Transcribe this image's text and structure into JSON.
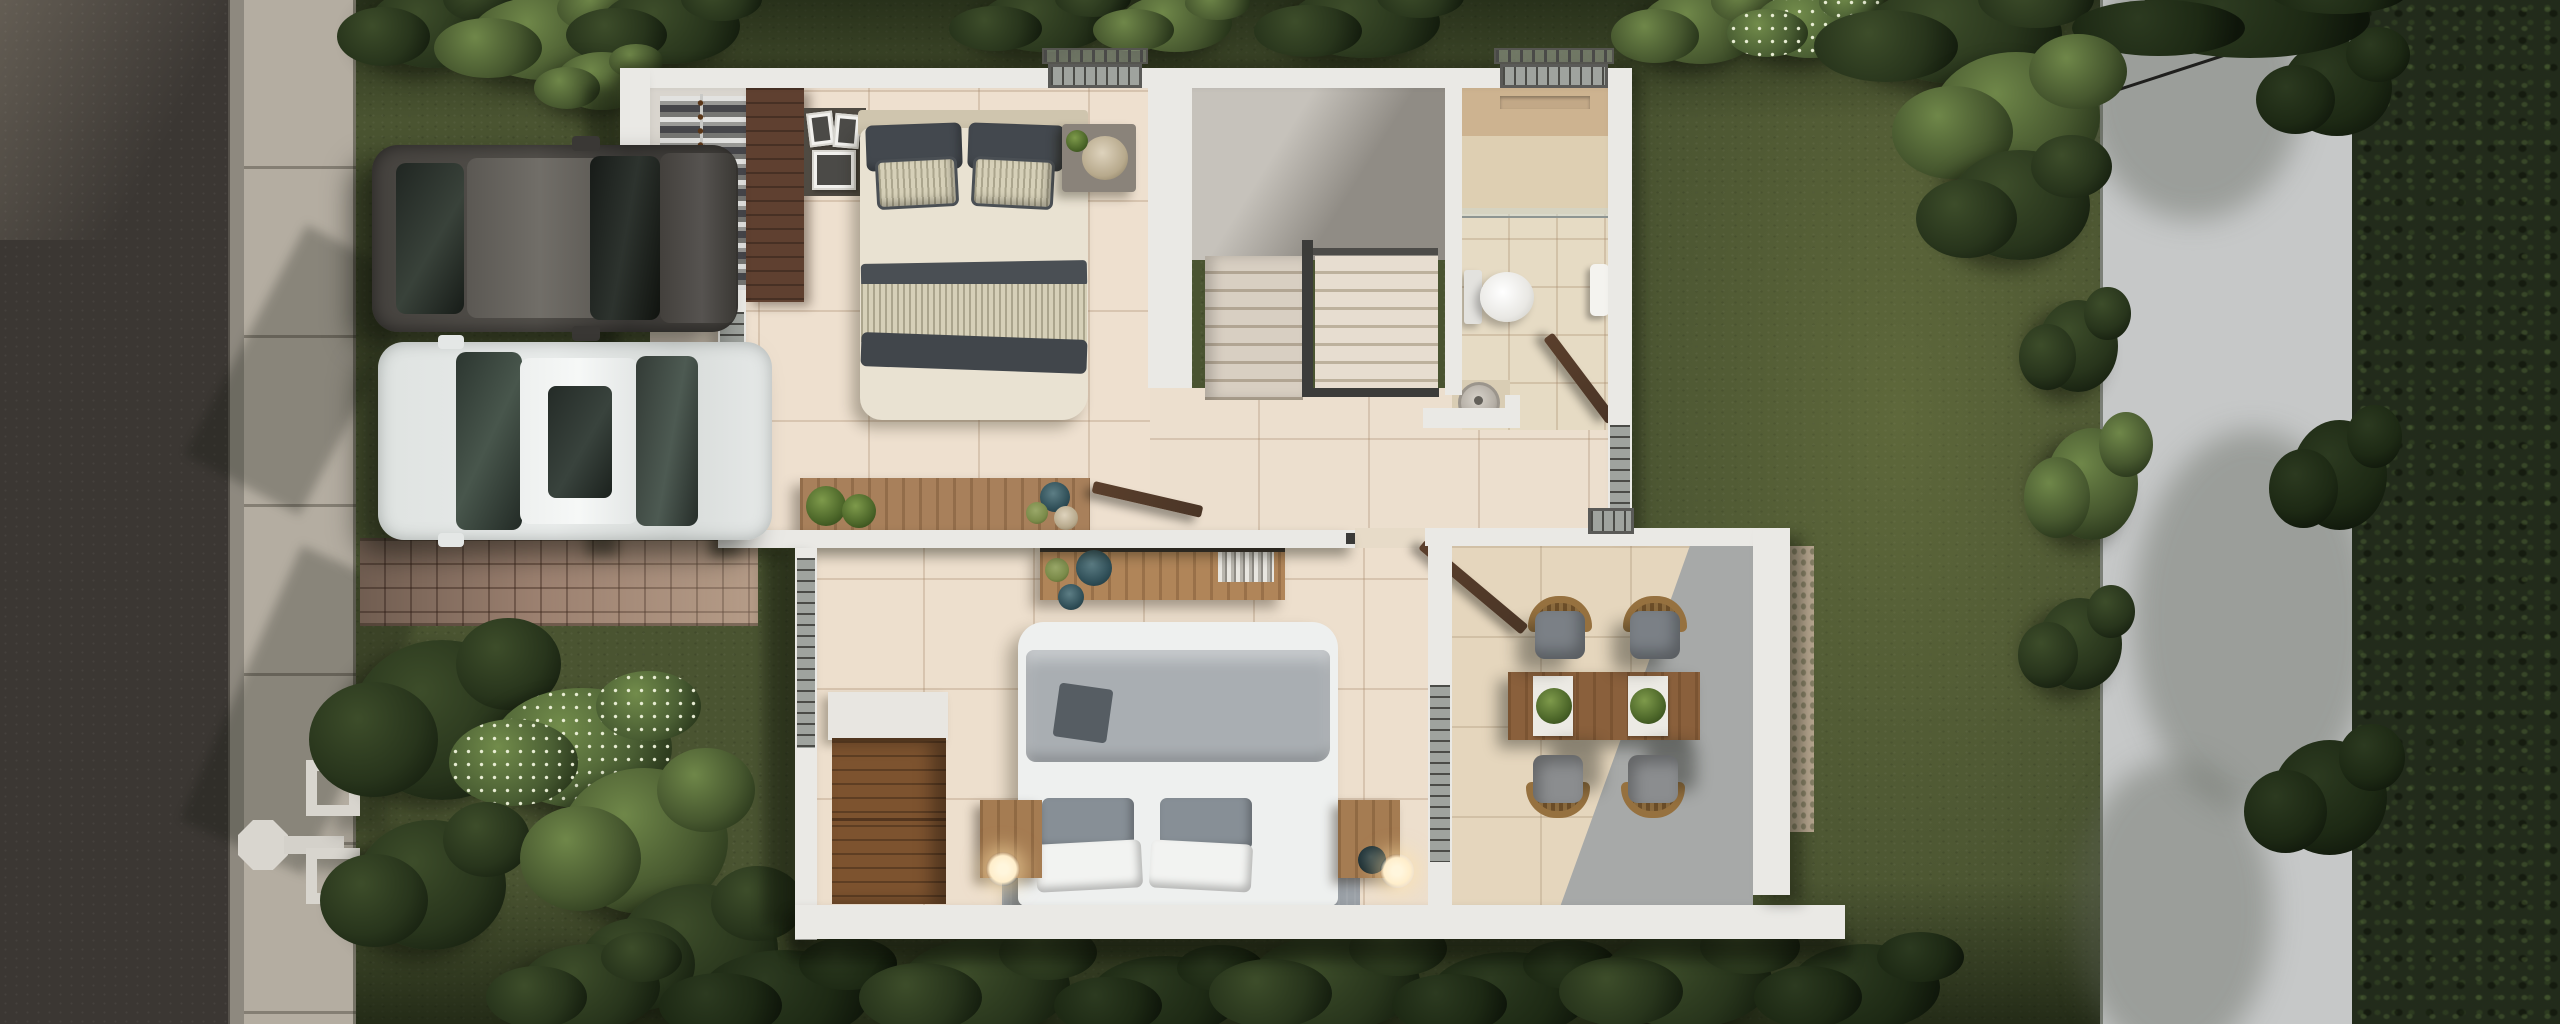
{
  "meta": {
    "title": "Top-down 3D architectural render — two-storey house floor plan with garden, driveway and terrace",
    "view": "top-down axonometric photorealistic render",
    "visible_text": "none"
  },
  "palette": {
    "grass": "#4a5431",
    "asphalt": "#3b3733",
    "curb": "#8e897f",
    "sidewalk": "#b4ada1",
    "paver": "#9c8170",
    "right_road": "#c6c8c8",
    "trees_dark": "#222b1b",
    "wall": "#eae9e5",
    "floor_tile": "#ecdfce",
    "bath_tan": "#cdb390",
    "stair_tread": "#d8cfc2",
    "stair_dark": "#8f8b84",
    "walnut": "#5f4030",
    "oak": "#a8805b",
    "wood_table": "#8a603c",
    "bed_cream": "#e9e2d2",
    "pillow_dark": "#43484e",
    "stripe_fabric": "#d6d0b8",
    "duvet_white": "#eef0ef",
    "blanket_gray": "#a9aeb2",
    "pillow_gray": "#878f96",
    "rug": "#9ba1a7",
    "cushion": "#7b8086",
    "rattan": "#96713f",
    "door_wood": "#4a3526",
    "suv": "#45423e",
    "sedan": "#e9eceb",
    "glass_dark": "#23272a",
    "glass": "#9fa39e",
    "lamp_glow": "#ffeecb",
    "toilet": "#f4f4f2",
    "towel": "#f4f3ef",
    "plant_green": "#5d7a3a",
    "vase_teal": "#2f4e57",
    "vase_green": "#7a8a49"
  },
  "scene": {
    "environment": [
      {
        "name": "asphalt-road",
        "position": "left edge, full height"
      },
      {
        "name": "concrete-sidewalk",
        "position": "left, beside road, with tree shadows"
      },
      {
        "name": "street-lamp",
        "position": "on sidewalk, lower left"
      },
      {
        "name": "paver-walkway",
        "position": "from sidewalk to house entrance"
      },
      {
        "name": "lawn-garden",
        "position": "surrounds house, tropical bushes along top, left and bottom"
      },
      {
        "name": "light-path",
        "position": "right side, vertical, full height"
      },
      {
        "name": "dense-trees",
        "position": "far right edge, full height"
      },
      {
        "name": "power-line",
        "position": "crossing right path diagonally near top"
      }
    ],
    "vehicles": [
      {
        "name": "dark-suv",
        "color": "#45423e",
        "orientation": "parked horizontally, front to the right"
      },
      {
        "name": "white-sedan",
        "color": "#e9eceb",
        "orientation": "parked horizontally, front to the left, dark sunroof"
      }
    ],
    "rooms": [
      {
        "id": "bedroom-1",
        "label": "Bedroom 1 (top-left)",
        "furniture": [
          "open closet with hanging clothes",
          "walnut wardrobe panel",
          "headboard shelf with photo frames",
          "double bed with dark and striped pillows",
          "nightstand with round tray and plant",
          "wooden bench console with potted plants and vases",
          "window to street with railing",
          "top window with railing"
        ]
      },
      {
        "id": "staircase",
        "label": "U-shaped staircase (top-center)",
        "furniture": [
          "two flights of stairs",
          "dark metal handrail",
          "upper floor void"
        ]
      },
      {
        "id": "bathroom",
        "label": "Bathroom (top-right)",
        "furniture": [
          "walk-in shower with glass partition",
          "toilet",
          "towel on rail",
          "round vessel sink on counter",
          "open wooden door",
          "top window with railing"
        ]
      },
      {
        "id": "master-bedroom",
        "label": "Master bedroom (bottom-center)",
        "furniture": [
          "king bed with white duvet, gray blanket and pillows",
          "two wooden nightstands with glowing lamps",
          "gray rug",
          "wooden dresser with white top",
          "wooden sideboard with books and vases",
          "open door to hallway",
          "window with railing"
        ]
      },
      {
        "id": "terrace",
        "label": "Dining terrace (bottom-right)",
        "furniture": [
          "wooden dining table with two white runners and two green centerpieces",
          "four rattan armchairs with gray cushions",
          "open wooden door",
          "window with railing",
          "gravel strip outside wall"
        ]
      }
    ]
  }
}
